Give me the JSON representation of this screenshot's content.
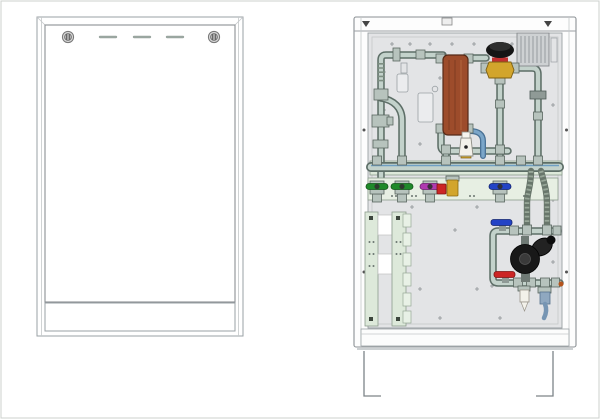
{
  "palette": {
    "background": "#ffffff",
    "outline": "#8b9094",
    "panel_gray": "#e3e4e6",
    "pipe": "#c3d2cb",
    "pipe_outline": "#5d6e67",
    "pipe_blue": "#7ba6c9",
    "rail_green": "#dde9da",
    "plate_green": "#e7efe3",
    "hx_copper": "#9d4c2b",
    "valve_green": "#1f8a2a",
    "valve_magenta": "#b03ab0",
    "valve_blue": "#2343c6",
    "valve_red": "#cc2525",
    "brass": "#d2a52c",
    "black_part": "#1d1d1d",
    "hose_dark": "#68766b",
    "white_part": "#f3f1ea",
    "ribbed_gray": "#ced1d3"
  },
  "left_view": {
    "kind": "closed-cabinet-front",
    "screw_count": 2,
    "vent_slot_count": 3
  },
  "right_view": {
    "kind": "open-cabinet-internals",
    "components": [
      {
        "id": "plate-heat-exchanger",
        "color_key": "hx_copper"
      },
      {
        "id": "thermostatic-mixing-valve",
        "color_key": "black_part"
      },
      {
        "id": "safety-valve",
        "color_key": "white_part"
      },
      {
        "id": "distribution-manifold",
        "color_key": "pipe"
      },
      {
        "id": "ball-valve-green",
        "count": 2,
        "color_key": "valve_green"
      },
      {
        "id": "ball-valve-magenta",
        "count": 1,
        "color_key": "valve_magenta"
      },
      {
        "id": "ball-valve-blue",
        "count": 2,
        "color_key": "valve_blue"
      },
      {
        "id": "ball-valve-red",
        "count": 1,
        "color_key": "valve_red"
      },
      {
        "id": "flexible-hose",
        "count": 2,
        "color_key": "hose_dark"
      },
      {
        "id": "circulation-pump",
        "color_key": "black_part"
      },
      {
        "id": "mounting-rail",
        "count": 4,
        "color_key": "rail_green"
      },
      {
        "id": "ribbed-cover",
        "color_key": "ribbed_gray"
      }
    ]
  }
}
